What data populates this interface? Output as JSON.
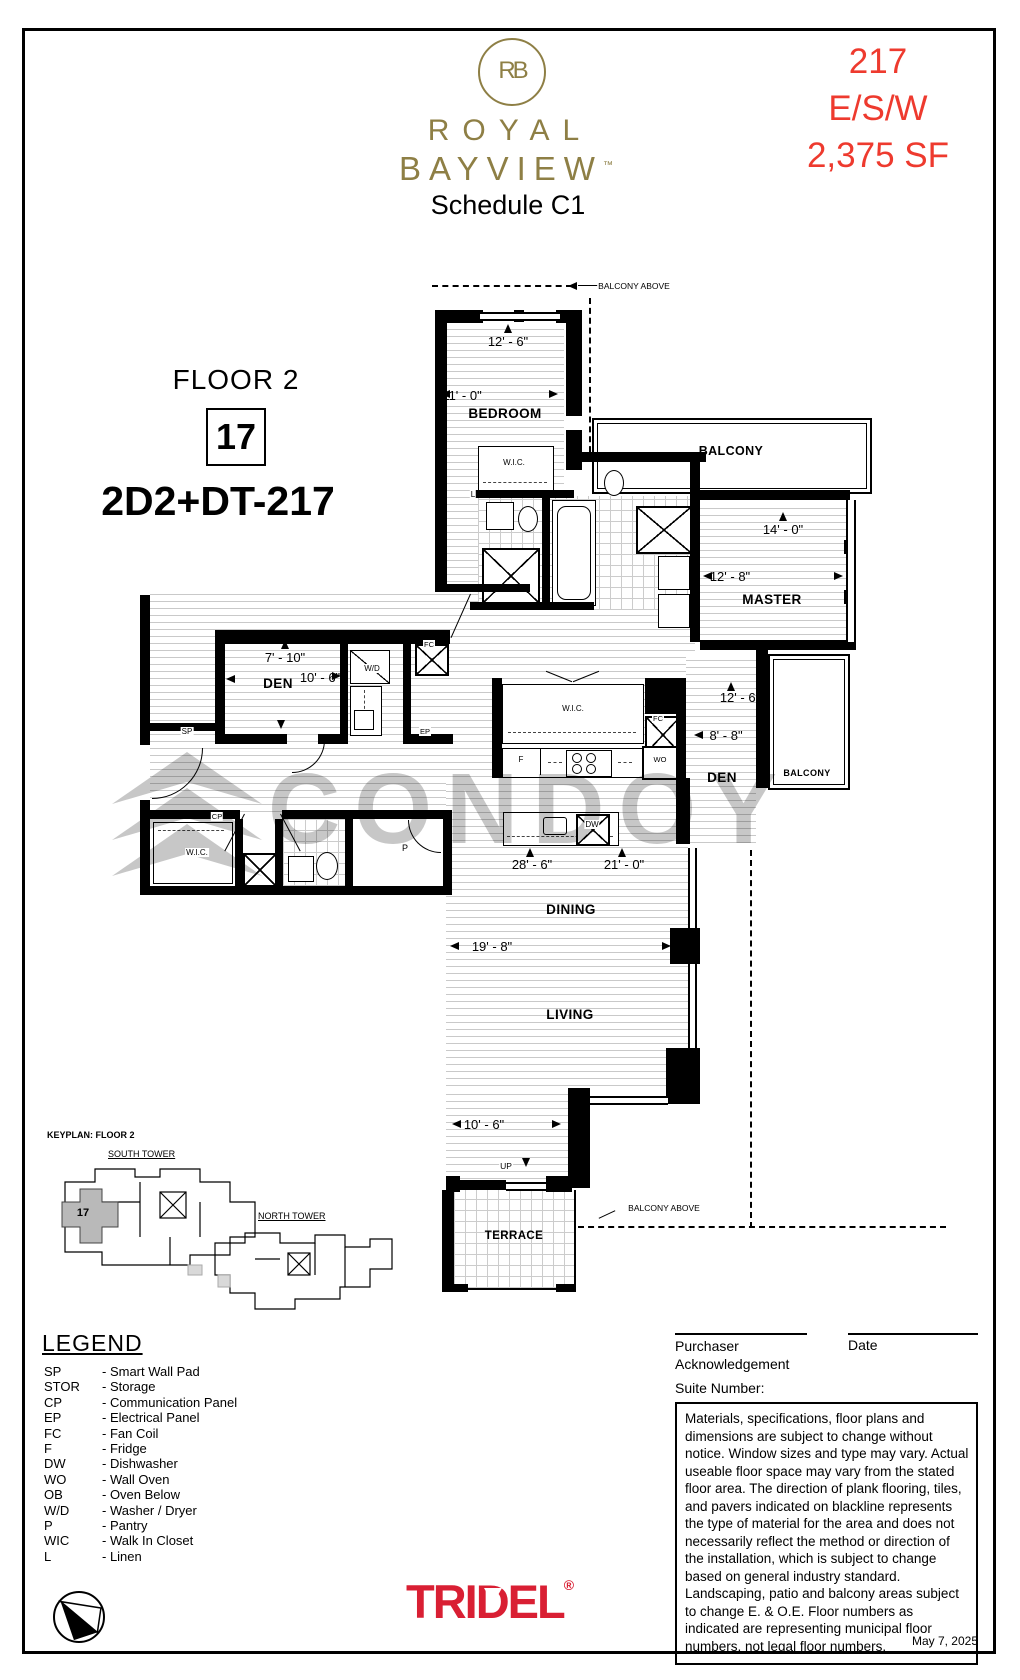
{
  "header": {
    "monogram": "RB",
    "brand1": "ROYAL",
    "brand2": "BAYVIEW",
    "trademark": "™",
    "schedule": "Schedule C1",
    "unit": "217",
    "exposure": "E/S/W",
    "area": "2,375 SF"
  },
  "title_block": {
    "floor": "FLOOR 2",
    "unit": "17",
    "model": "2D2+DT-217"
  },
  "plan": {
    "balcony_above": "BALCONY ABOVE",
    "rooms": {
      "bedroom": "BEDROOM",
      "master": "MASTER",
      "den": "DEN",
      "dining": "DINING",
      "living": "LIVING",
      "terrace": "TERRACE",
      "balcony": "BALCONY",
      "wic": "W.I.C."
    },
    "dims": {
      "bedroom_w": "12' - 6\"",
      "bedroom_d": "11' - 0\"",
      "master_w": "14' - 0\"",
      "master_d": "12' - 8\"",
      "den1_d": "7' - 10\"",
      "den1_w": "10' - 6\"",
      "den2_d": "12' - 6\"",
      "den2_w": "8' - 8\"",
      "great_a": "28' - 6\"",
      "great_b": "21' - 0\"",
      "living_d": "19' - 8\"",
      "living_w": "10' - 6\""
    },
    "tags": {
      "sp": "SP",
      "cp": "CP",
      "ep": "EP",
      "fc": "FC",
      "f": "F",
      "dw": "DW",
      "wo": "WO",
      "wd": "W/D",
      "p": "P",
      "l": "L",
      "up": "UP"
    }
  },
  "watermark": {
    "text": "CONDOY"
  },
  "keyplan": {
    "title": "KEYPLAN: FLOOR 2",
    "south": "SOUTH TOWER",
    "north": "NORTH TOWER",
    "unit": "17"
  },
  "legend": {
    "title": "LEGEND",
    "items": [
      {
        "abbr": "SP",
        "desc": "- Smart Wall Pad"
      },
      {
        "abbr": "STOR",
        "desc": "- Storage"
      },
      {
        "abbr": "CP",
        "desc": "- Communication Panel"
      },
      {
        "abbr": "EP",
        "desc": "- Electrical Panel"
      },
      {
        "abbr": "FC",
        "desc": "- Fan Coil"
      },
      {
        "abbr": "F",
        "desc": "- Fridge"
      },
      {
        "abbr": "DW",
        "desc": "- Dishwasher"
      },
      {
        "abbr": "WO",
        "desc": "- Wall Oven"
      },
      {
        "abbr": "OB",
        "desc": "- Oven Below"
      },
      {
        "abbr": "W/D",
        "desc": "- Washer / Dryer"
      },
      {
        "abbr": "P",
        "desc": "- Pantry"
      },
      {
        "abbr": "WIC",
        "desc": "- Walk In Closet"
      },
      {
        "abbr": "L",
        "desc": "- Linen"
      }
    ]
  },
  "signoff": {
    "purchaser1": "Purchaser",
    "purchaser2": "Acknowledgement",
    "date_label": "Date",
    "suite_label": "Suite Number:"
  },
  "disclaimer": {
    "text": "Materials, specifications, floor plans and dimensions are subject to change without notice. Window sizes and type may vary. Actual useable floor space may vary from the stated floor area. The direction of plank flooring, tiles, and pavers indicated on blackline represents the type of material for the area and does not necessarily reflect the method or direction of the installation, which is subject to change based on general industry standard. Landscaping, patio and balcony areas subject to change E. & O.E. Floor numbers as indicated are representing municipal floor numbers, not legal floor numbers."
  },
  "brand": {
    "tridel_tri": "TRI",
    "tridel_d": "D",
    "tridel_el": "EL",
    "registered": "®"
  },
  "footer": {
    "date": "May 7, 2025"
  },
  "colors": {
    "gold": "#8e7f45",
    "red": "#ee3a2e",
    "tridel_red": "#d91f33"
  }
}
